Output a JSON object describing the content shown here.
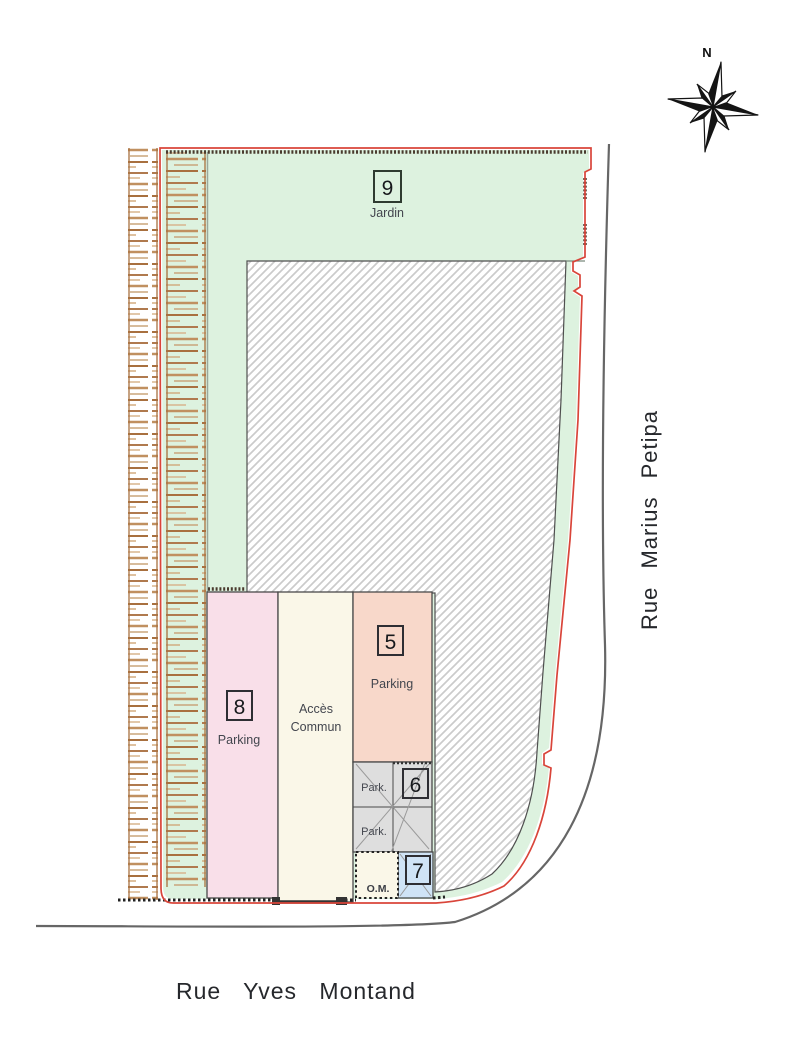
{
  "plan": {
    "compass": {
      "north_label": "N"
    },
    "streets": {
      "right_vertical": "Rue Marius Petipa",
      "bottom_horizontal": "Rue Yves Montand"
    },
    "lots": {
      "lot9": {
        "number": "9",
        "label": "Jardin"
      },
      "lot8": {
        "number": "8",
        "label": "Parking"
      },
      "acces_commun": {
        "label_line1": "Accès",
        "label_line2": "Commun"
      },
      "lot5": {
        "number": "5",
        "label": "Parking"
      },
      "lot6": {
        "number": "6"
      },
      "lot7": {
        "number": "7"
      },
      "parking_cells": {
        "cell_top": "Park.",
        "cell_bottom": "Park."
      },
      "om_cell": {
        "label": "O.M."
      }
    },
    "colors": {
      "garden_green": "#ddf2df",
      "parking8_pink": "#f9dfe9",
      "acces_cream": "#faf7e8",
      "parking5_salmon": "#f8d8ca",
      "parking_gray": "#dedede",
      "lot7_blue": "#cfe3f6",
      "boundary_red": "#d9453a",
      "hedge_brown": "#b07a4e",
      "street_gray": "#666666",
      "hatch_gray": "#cccccc"
    }
  }
}
